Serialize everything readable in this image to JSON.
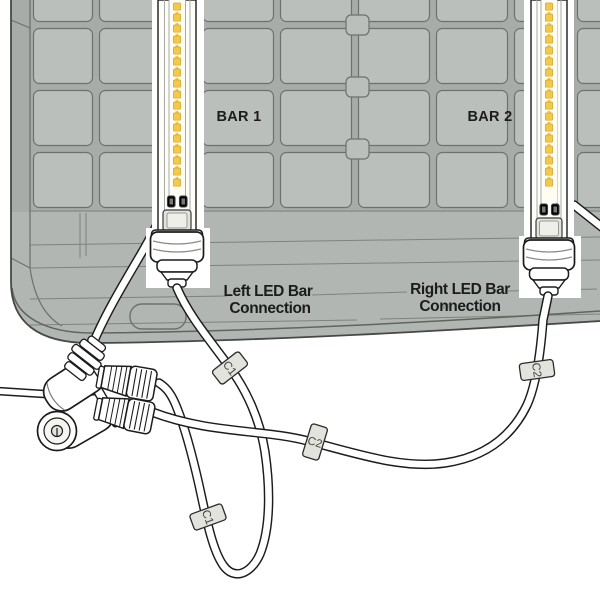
{
  "diagram": {
    "title_labels": {
      "bar1": "BAR 1",
      "bar2": "BAR 2"
    },
    "connection_labels": {
      "left_line1": "Left LED Bar",
      "left_line2": "Connection",
      "right_line1": "Right LED Bar",
      "right_line2": "Connection"
    },
    "cable_tags": {
      "c1": "C1",
      "c2": "C2"
    },
    "colors": {
      "background": "#ffffff",
      "panel_gray": "#b2b6b2",
      "panel_cell_gray": "#bbbfbb",
      "panel_line": "#6d726d",
      "panel_edge_dark": "#454a45",
      "led_yellow": "#f2c94c",
      "outline_black": "#1c1c1c",
      "tag_fill": "#e3e3de"
    }
  }
}
